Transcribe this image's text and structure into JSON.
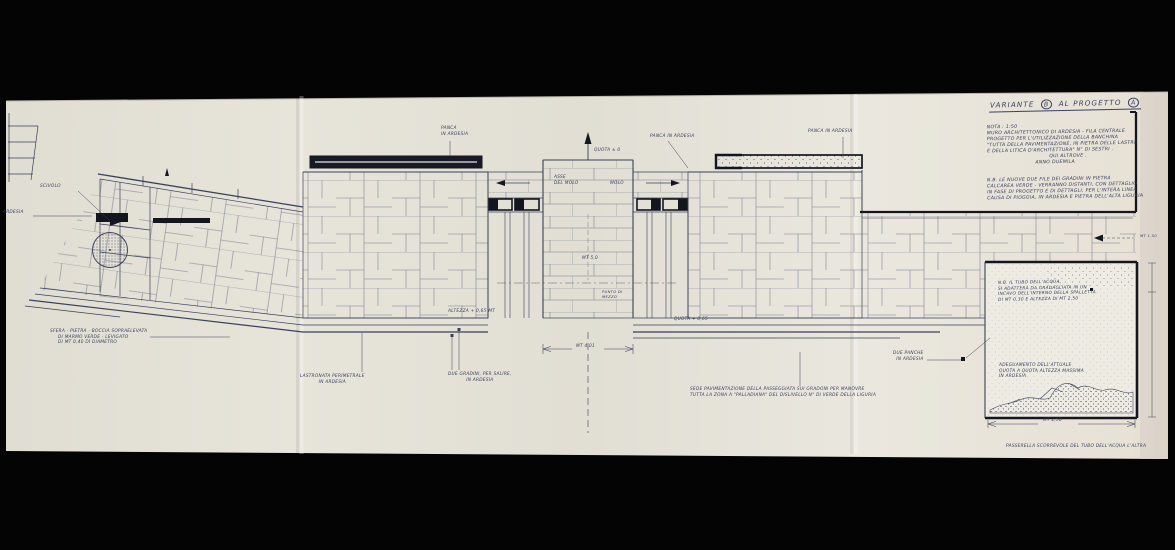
{
  "title": {
    "word1": "VARIANTE",
    "letter_b": "B",
    "word2": "AL PROGETTO",
    "letter_a": "A"
  },
  "notes": {
    "block1": [
      "NOTA : 1:50",
      "MURO ARCHITETTONICO DI ARDESIA - FILA CENTRALE",
      "PROGETTO PER L'UTILIZZAZIONE DELLA BANCHINA",
      "\"TUTTA DELLA PAVIMENTAZIONE, IN PIETRA DELLE LASTRE",
      "E DELLA LITICA D'ARCHITETTURA\"   N° DI SESTRI .",
      "QUI ALTROVE .",
      "ANNO DUEMILA"
    ],
    "nb_block": [
      "N.B. LE NUOVE DUE FILE DEI GRADINI IN PIETRA",
      "CALCAREA VERDE - VERRANNO DISTANTI, CON DETTAGLIO",
      "IN FASE DI PROGETTO E DI DETTAGLI, PER L'INTERA LINEA",
      "CAUSA DI PIOGGIA, IN ARDESIA E PIETRA DELL'ALTA LIGURIA"
    ],
    "nb_right": [
      "N.B. IL TUBO DELL'ACQUA,",
      "SI ADATTERÀ DA GRADAGLIATA IN UN",
      "INCAVO DELL'INTERNO DELLA SPALLETTA",
      "DI MT 0,30 E ALTEZZA DI MT 2,50"
    ],
    "box_text": [
      "ADEGUAMENTO DELL'ATTUALE",
      "QUOTA A QUOTA ALTEZZA MASSIMA",
      "IN ARDESIA"
    ],
    "passeggiata": [
      "SEDE PAVIMENTAZIONE DELLA PASSEGGIATA SUI GRADONI PER MANOVRE",
      "TUTTA LA ZONA A \"PALLADIANA\" DEL DISLIVELLO N° DI VERDE DELLA LIGURIA"
    ],
    "sphere": [
      "SFERA - PIETRA - BOCCIA SOPRAELEVATA",
      "DI MARMO VERDE - LEVIGATO",
      "DI MT 0,40 DI DIAMETRO"
    ]
  },
  "labels": {
    "scivolo": "SCIVOLO",
    "ardesia": "ARDESIA",
    "panca_left_1": "PANCA",
    "panca_left_2": "IN ARDESIA",
    "panca_mid": "PANCA IN ARDESIA",
    "panca_right": "PANCA IN ARDESIA",
    "quota_zero": "QUOTA ± 0",
    "asse_1": "ASSE",
    "asse_2": "DEL MOLO",
    "molo": "MOLO",
    "mt5": "MT 5,0",
    "punto_1": "PUNTO DI",
    "punto_2": "MEZZO",
    "alt_left": "ALTEZZA + 0,65 MT",
    "quota_right": "QUOTA + 0,65",
    "lastronata_1": "LASTRONATA PERIMETRALE",
    "lastronata_2": "IN ARDESIA",
    "gradini_1": "DUE GRADINI, PER SALIRE,",
    "gradini_2": "IN ARDESIA",
    "due_panche_1": "DUE PANCHE",
    "due_panche_2": "IN ARDESIA"
  },
  "dimensions": {
    "center": "MT 4,01",
    "box": "MT 2,50",
    "walkway": "MT 1,50",
    "caption": "PASSERELLA SCORREVOLE DEL TUBO DELL'ACQUA L'ALTRA"
  },
  "colors": {
    "ink": "#3a4158",
    "heavy_ink": "#14161f",
    "paper": "#e6e3da"
  }
}
